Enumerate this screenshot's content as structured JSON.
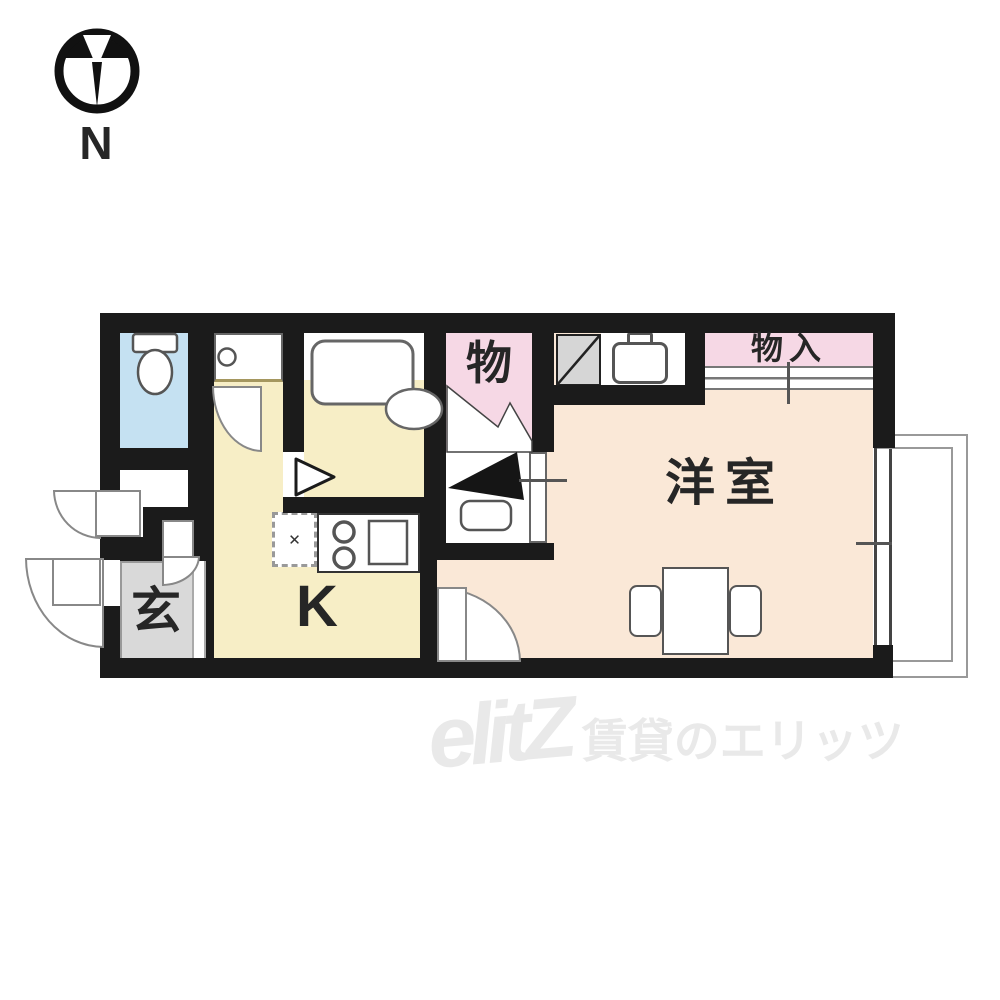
{
  "compass": {
    "north": "N"
  },
  "rooms": {
    "western_room": {
      "label": "洋室",
      "color": "#fae8d7"
    },
    "kitchen": {
      "label": "K",
      "color": "#f7eec6"
    },
    "entrance": {
      "label": "玄",
      "color": "#d9d9d9"
    },
    "storage": {
      "label": "物",
      "color": "#f6d8e5"
    },
    "closet": {
      "label": "物入",
      "color": "#f6d8e5"
    },
    "toilet": {
      "color": "#c5e1f2"
    },
    "bathroom": {
      "color": "#c5e1f2"
    }
  },
  "fixtures": {
    "refrigerator_marker_glyph": "✕"
  },
  "watermark": {
    "logo": "elitZ",
    "caption": "賃貸のエリッツ",
    "color": "#e9e9e9"
  },
  "colors": {
    "wall": "#1b1b1b",
    "water": "#c5e1f2",
    "cream": "#f7eec6",
    "peach": "#fae8d7",
    "pink": "#f6d8e5",
    "gray": "#d9d9d9",
    "wm": "#e9e9e9"
  }
}
